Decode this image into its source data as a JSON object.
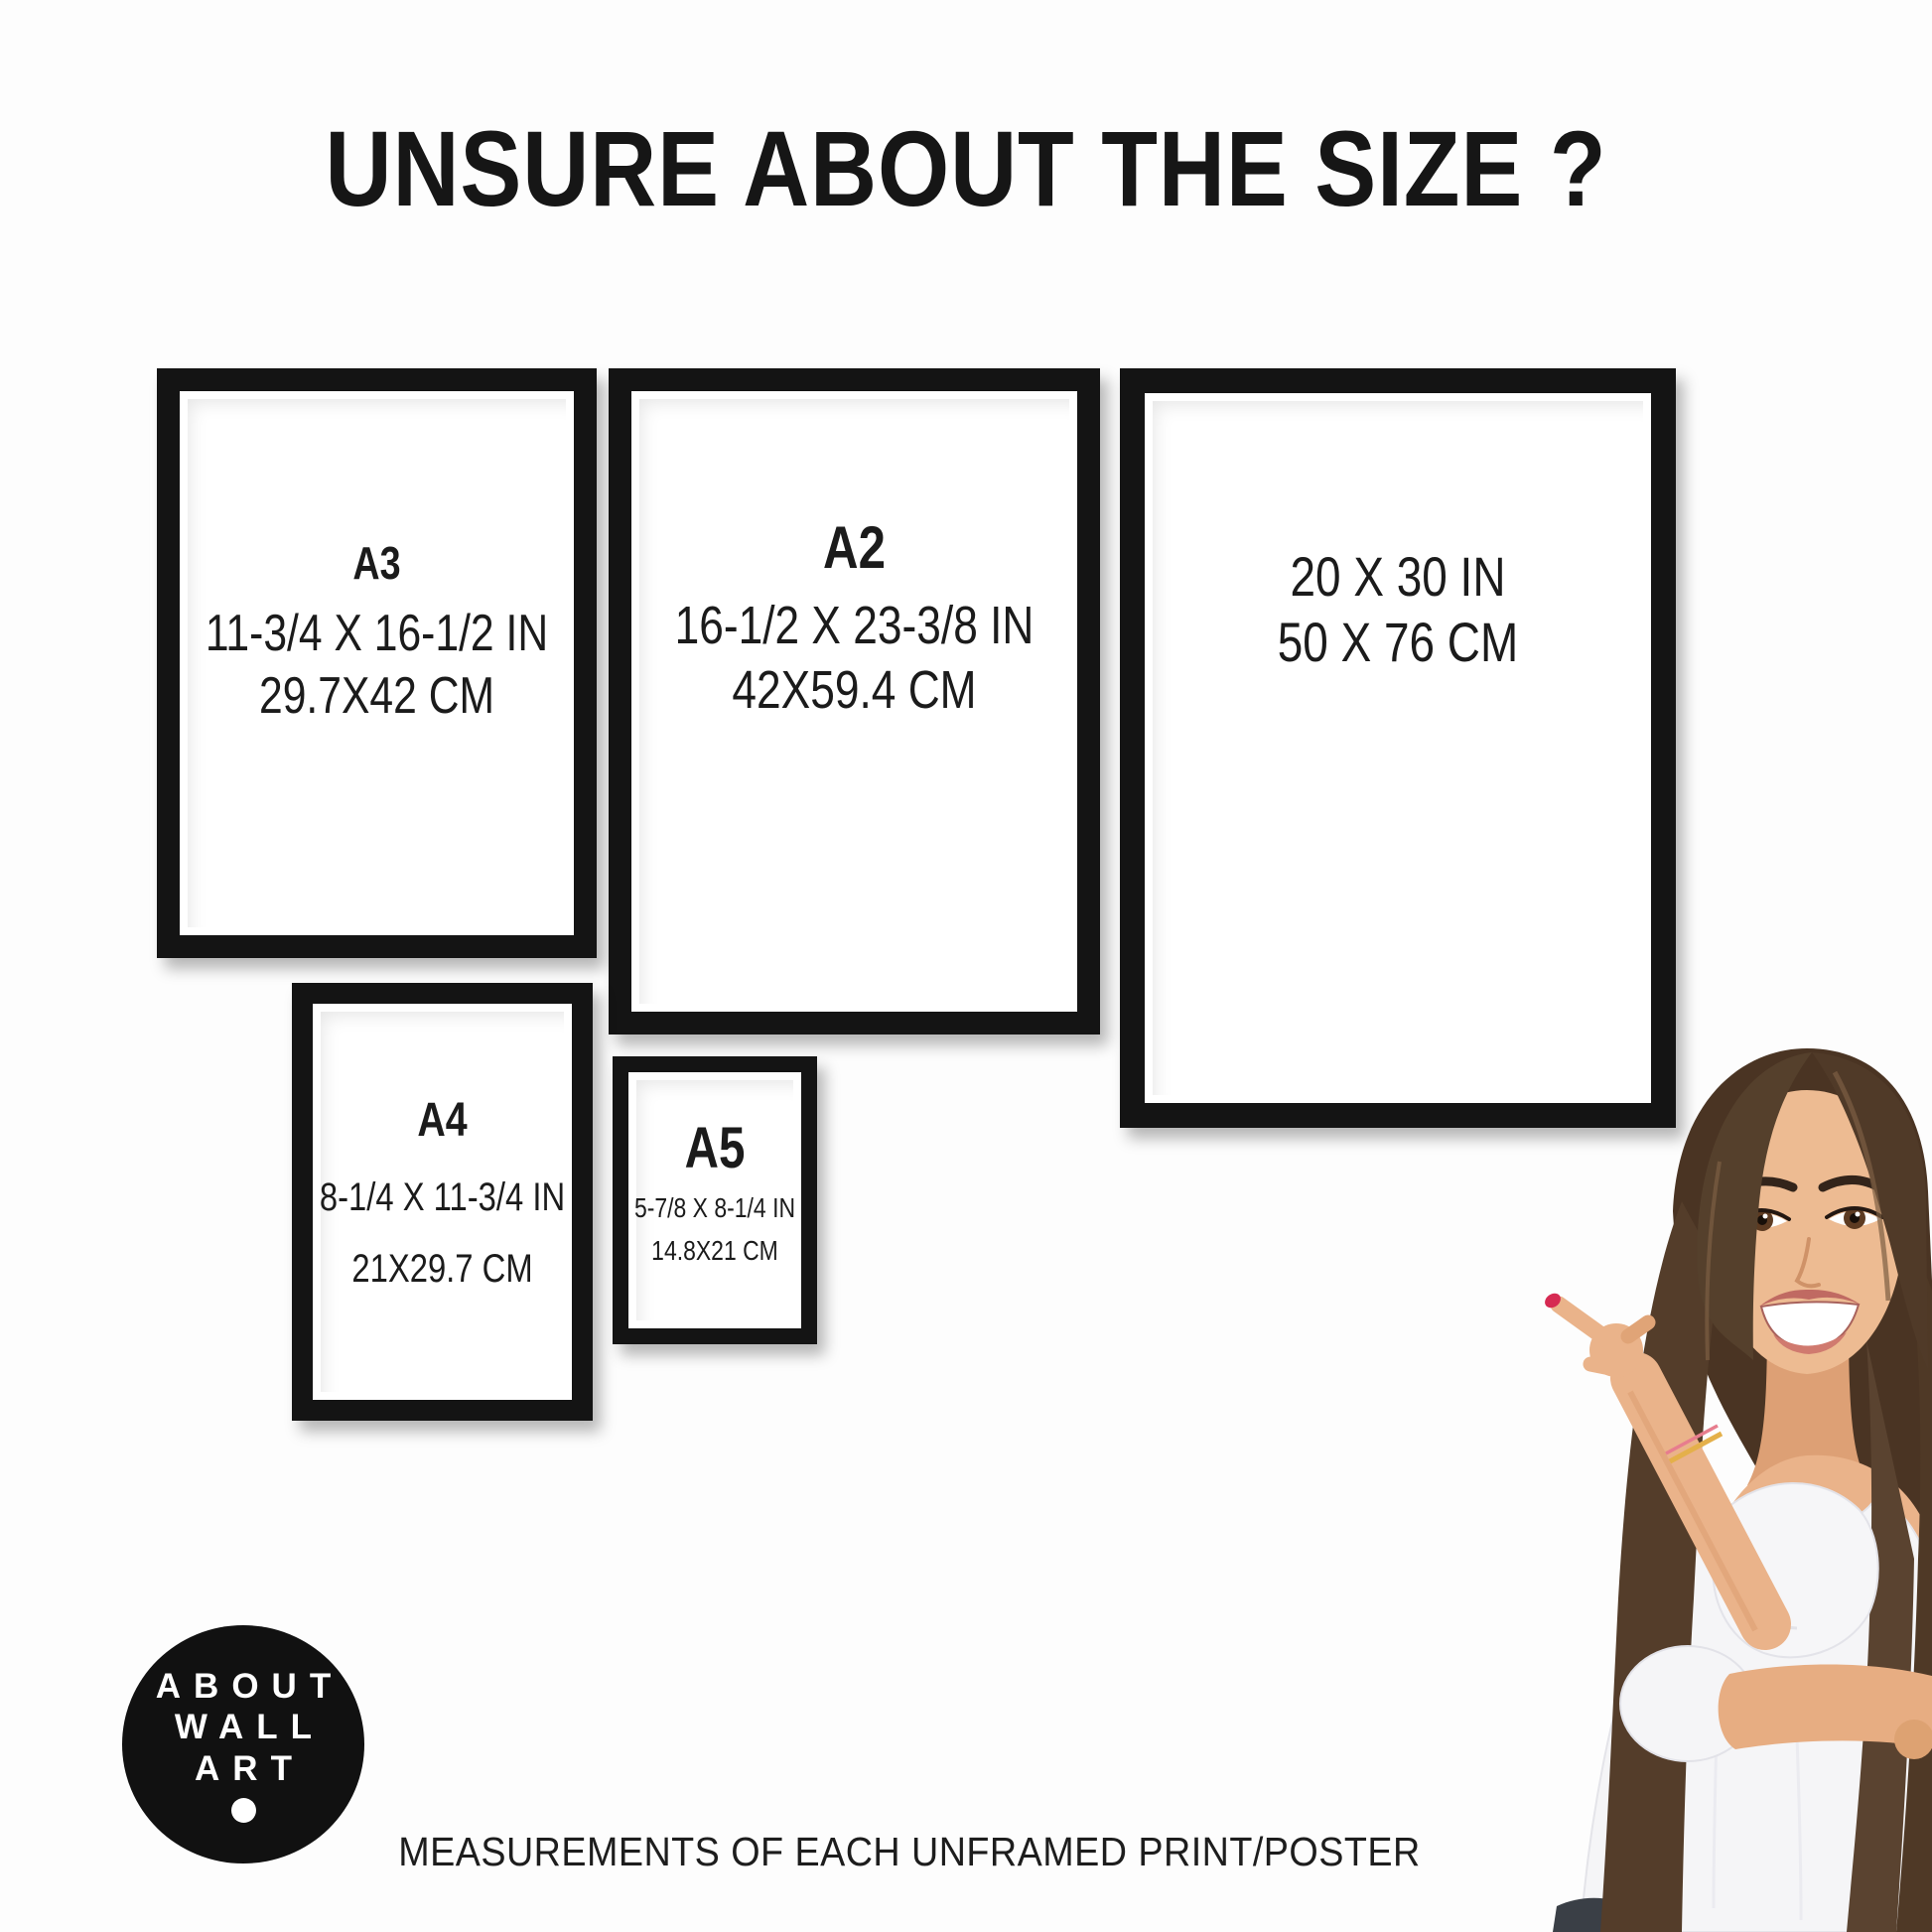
{
  "page": {
    "title": "UNSURE ABOUT THE SIZE ?",
    "footer_caption": "MEASUREMENTS OF EACH UNFRAMED PRINT/POSTER",
    "background_color": "#fdfdfd",
    "frame_color": "#141414",
    "text_color": "#1b1b1b"
  },
  "frames": [
    {
      "id": "a3",
      "label": "A3",
      "inches": "11-3/4 X 16-1/2 IN",
      "cm": "29.7X42 CM"
    },
    {
      "id": "a2",
      "label": "A2",
      "inches": "16-1/2 X 23-3/8 IN",
      "cm": "42X59.4 CM"
    },
    {
      "id": "20x30",
      "label": "",
      "inches": "20 X 30 IN",
      "cm": "50 X 76 CM"
    },
    {
      "id": "a4",
      "label": "A4",
      "inches": "8-1/4 X 11-3/4 IN",
      "cm": "21X29.7 CM"
    },
    {
      "id": "a5",
      "label": "A5",
      "inches": "5-7/8 X 8-1/4 IN",
      "cm": "14.8X21 CM"
    }
  ],
  "logo": {
    "line1": "ABOUT",
    "line2": "WALL",
    "line3": "ART",
    "background_color": "#111111",
    "text_color": "#ffffff"
  },
  "photo": {
    "alt": "Smiling woman with long brown hair in a white off-shoulder top pointing at the size chart",
    "nail_color": "#d62a52"
  }
}
